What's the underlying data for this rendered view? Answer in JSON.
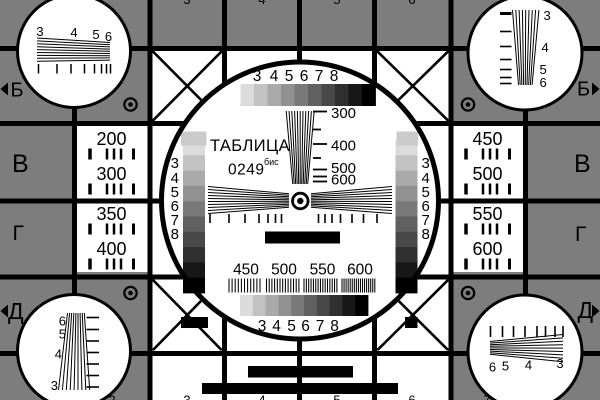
{
  "card": {
    "title": "ТАБЛИЦА",
    "code": "0249",
    "code_suffix": "бис",
    "colors": {
      "background_gray": "#7d7d7d",
      "ink": "#000000",
      "paper": "#ffffff",
      "patch_light": "#cbcbcb"
    }
  },
  "row_markers": {
    "left": [
      "Б",
      "В",
      "Г",
      "Д"
    ],
    "right": [
      "Б",
      "В",
      "Г",
      "Д"
    ]
  },
  "column_digit_stubs": {
    "top": [
      "3",
      "4",
      "5",
      "6"
    ],
    "bottom": [
      "2",
      "3",
      "4",
      "5",
      "6",
      "7"
    ]
  },
  "center_circle": {
    "grayscale_digits_top": [
      "3",
      "4",
      "5",
      "6",
      "7",
      "8"
    ],
    "grayscale_digits_bottom": [
      "3",
      "4",
      "5",
      "6",
      "7",
      "8"
    ],
    "grayscale_digits_left": [
      "3",
      "4",
      "5",
      "6",
      "7",
      "8"
    ],
    "grayscale_digits_right": [
      "3",
      "4",
      "5",
      "6",
      "7",
      "8"
    ],
    "grayscale_steps": [
      "#dbdbdb",
      "#c2c2c2",
      "#aaaaaa",
      "#919191",
      "#797979",
      "#606060",
      "#484848",
      "#2f2f2f",
      "#171717",
      "#000000"
    ],
    "line_frequency_labels": [
      "300",
      "400",
      "500",
      "600"
    ],
    "burst_frequency_labels": [
      "450",
      "500",
      "550",
      "600"
    ]
  },
  "side_frequency_cells": {
    "left_top": [
      "200",
      "300"
    ],
    "left_bottom": [
      "350",
      "400"
    ],
    "right_top": [
      "450",
      "500"
    ],
    "right_bottom": [
      "550",
      "600"
    ]
  },
  "corner_test_circles": {
    "top_left_digits": [
      "3",
      "4",
      "5",
      "6"
    ],
    "top_right_digits": [
      "3",
      "4",
      "5",
      "6"
    ],
    "bottom_left_digits": [
      "6",
      "5",
      "4",
      "3"
    ],
    "bottom_right_digits": [
      "6",
      "5",
      "4",
      "3"
    ]
  }
}
